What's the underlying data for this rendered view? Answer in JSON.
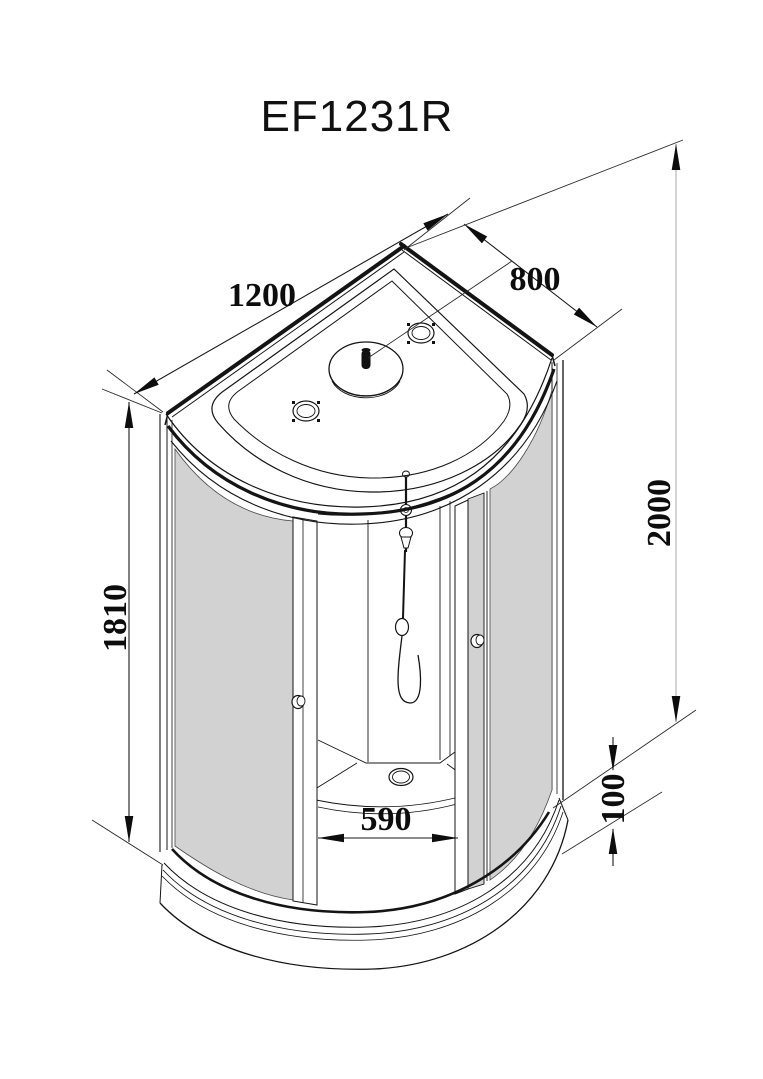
{
  "title": "EF1231R",
  "dimensions": {
    "overall_width": "1200",
    "overall_depth": "800",
    "overall_height": "2000",
    "glass_panel_height": "1810",
    "door_opening_width": "590",
    "tray_height": "100"
  },
  "colors": {
    "line": "#141414",
    "glass": "#d2d2d2",
    "background": "#ffffff",
    "height_dim_line": "#c9c9c9"
  }
}
